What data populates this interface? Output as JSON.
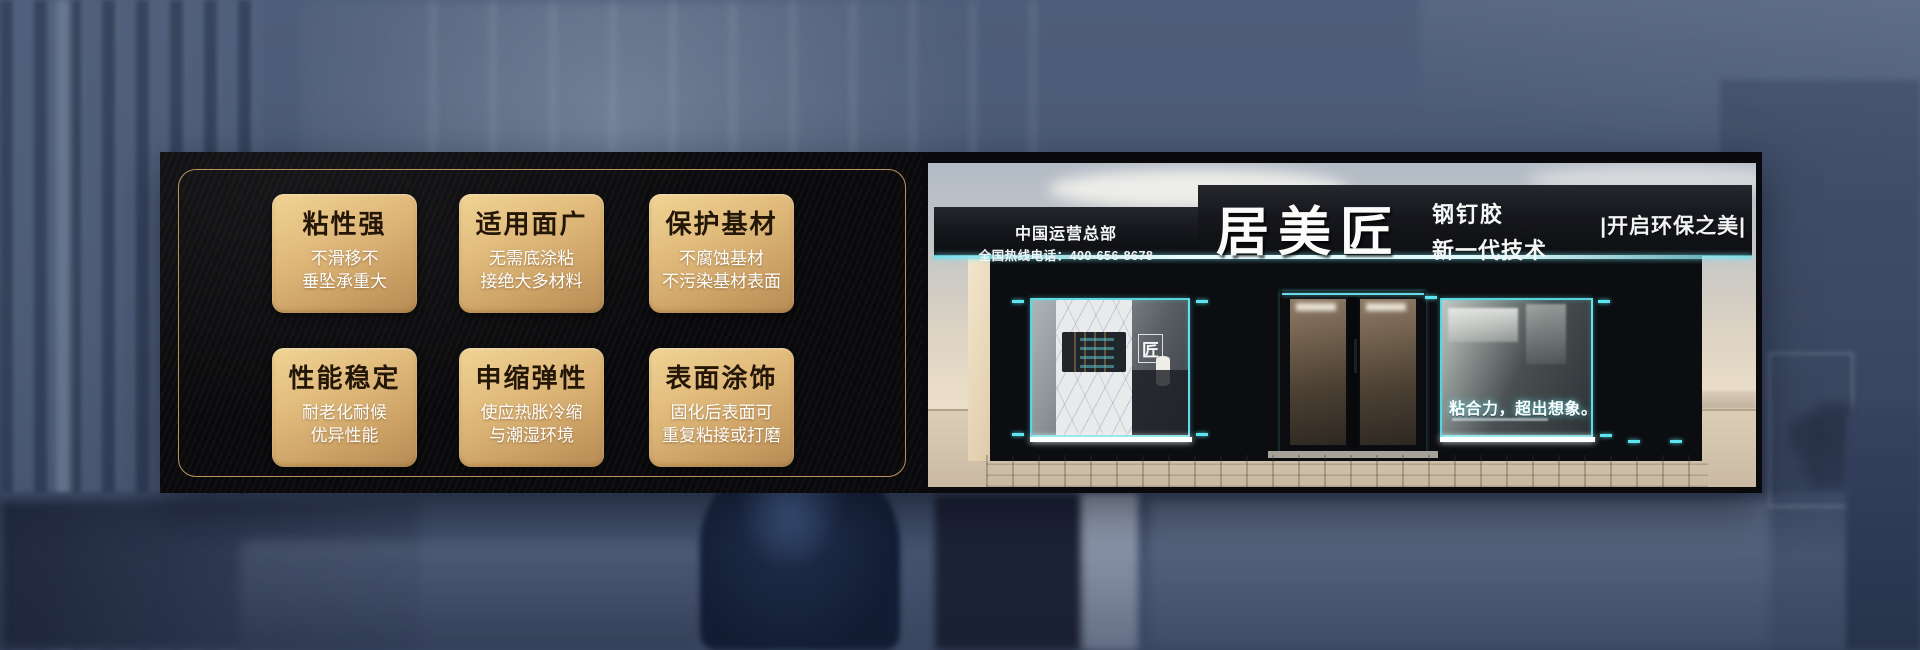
{
  "banner": {
    "colors": {
      "panel_black": "#0a0a0c",
      "gold_frame": "#bb945c",
      "card_gold_light": "#f0d494",
      "card_gold_dark": "#b68c55",
      "accent_teal": "#5ce4f0",
      "sign_black": "#17181d",
      "background_blue": "#4a5974"
    }
  },
  "features": {
    "cards": [
      {
        "title": "粘性强",
        "line1": "不滑移不",
        "line2": "垂坠承重大"
      },
      {
        "title": "适用面广",
        "line1": "无需底涂粘",
        "line2": "接绝大多材料"
      },
      {
        "title": "保护基材",
        "line1": "不腐蚀基材",
        "line2": "不污染基材表面"
      },
      {
        "title": "性能稳定",
        "line1": "耐老化耐候",
        "line2": "优异性能"
      },
      {
        "title": "申缩弹性",
        "line1": "使应热胀冷缩",
        "line2": "与潮湿环境"
      },
      {
        "title": "表面涂饰",
        "line1": "固化后表面可",
        "line2": "重复粘接或打磨"
      }
    ]
  },
  "storefront": {
    "hq_line1": "中国运营总部",
    "hq_line2": "全国热线电话：400-656-8678",
    "brand": "居美匠",
    "product": "钢钉胶",
    "tech": "新一代技术",
    "tagline_right": "|开启环保之美|",
    "window_slogan": "粘合力，超出想象。",
    "window_logo": "匠"
  }
}
